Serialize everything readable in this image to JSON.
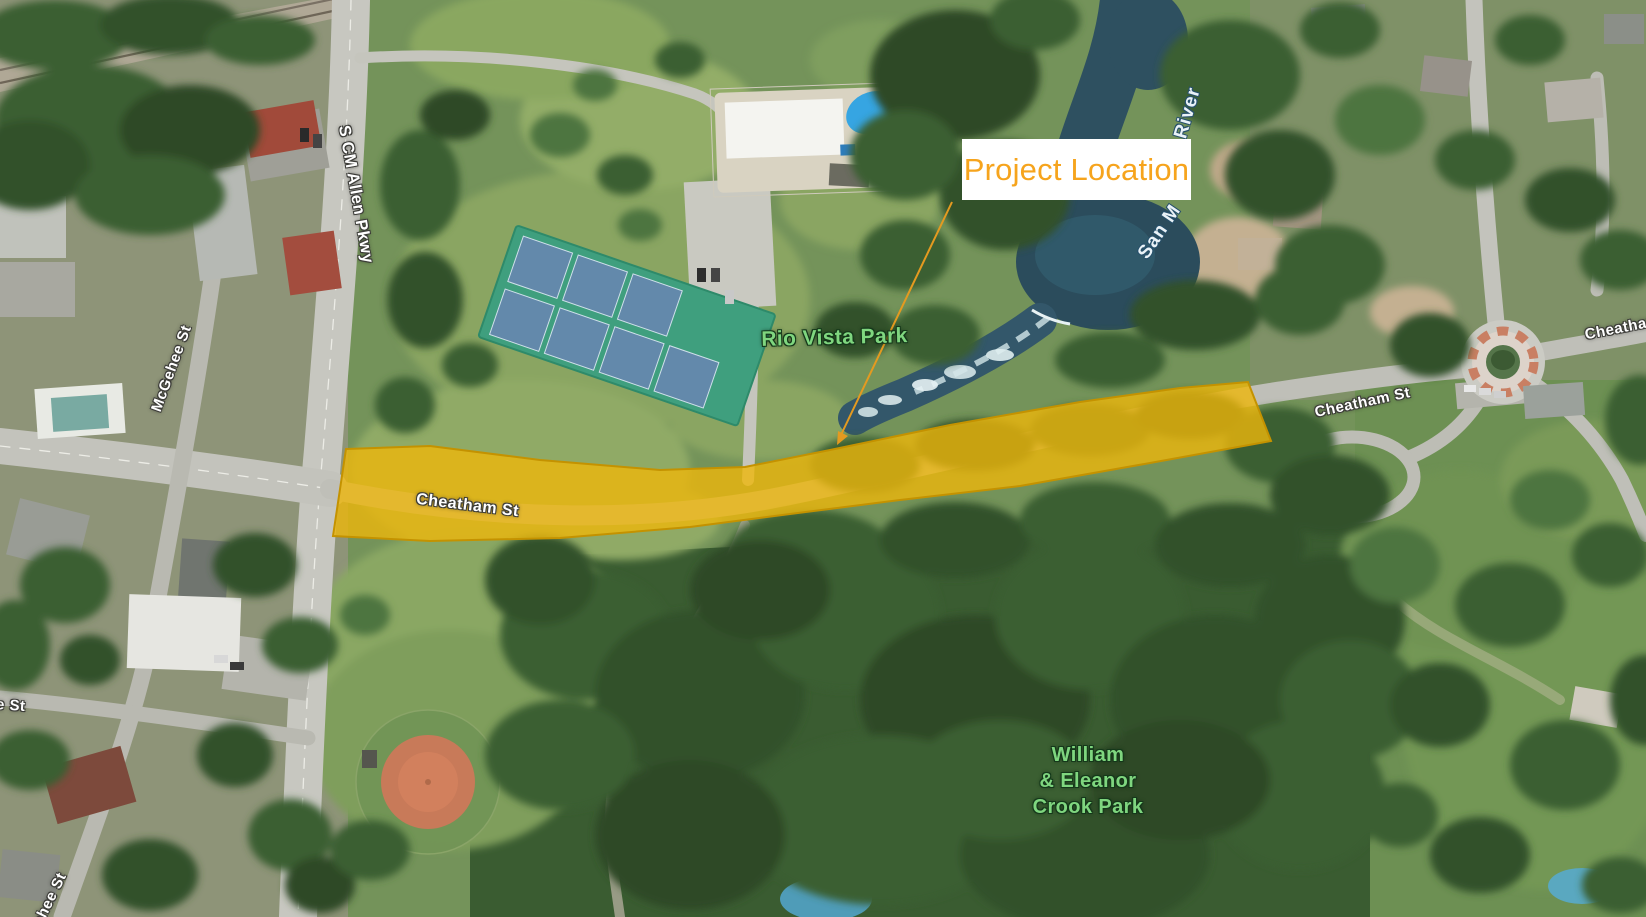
{
  "map": {
    "description": "Aerial satellite exhibit showing a highlighted roadway project corridor",
    "callout": {
      "label": "Project Location",
      "text_color": "#F6A41D",
      "box_color": "#FFFFFF",
      "arrow_color": "#E49A20"
    },
    "highlight_corridor": {
      "street": "Cheatham St",
      "label": "Cheatham St",
      "fill": "#EDB70B",
      "stroke": "#C49200"
    },
    "street_labels": {
      "s_cm_allen_pkwy": "S CM Allen Pkwy",
      "mcgehee_st_upper": "McGehee St",
      "mcgehee_st_lower": "McGehee St",
      "e_st_partial": "e St",
      "cheatham_st_east": "Cheatham St",
      "cheatham_st_far_east": "Cheatham St"
    },
    "place_labels": {
      "rio_vista_park": "Rio Vista Park",
      "crook_park_lines": [
        "William",
        "& Eleanor",
        "Crook Park"
      ],
      "park_label_color": "#7FD67F",
      "street_label_color": "#FFFFFF"
    },
    "water_labels": {
      "river_fragment_upper": "River",
      "river_fragment_lower": "San M",
      "label_color": "#E9F2F7"
    }
  }
}
